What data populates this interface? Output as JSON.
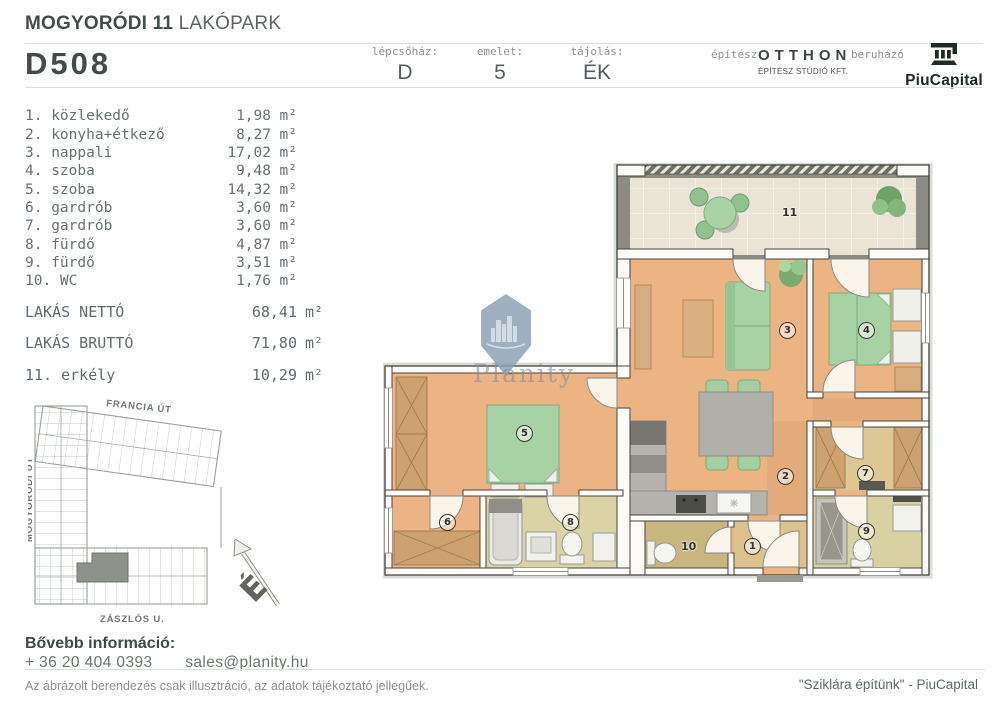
{
  "header": {
    "project_bold": "MOGYORÓDI 11",
    "project_light": "LAKÓPARK",
    "unit_id": "D508",
    "meta": [
      {
        "label": "lépcsőház:",
        "value": "D"
      },
      {
        "label": "emelet:",
        "value": "5"
      },
      {
        "label": "tájolás:",
        "value": "ÉK"
      }
    ],
    "architect_label": "építész",
    "architect_name": "OTTHON",
    "architect_sub": "ÉPÍTÉSZ STÚDIÓ KFT.",
    "developer_label": "beruházó",
    "developer_name": "PiuCapital"
  },
  "units": {
    "m2": "m²"
  },
  "rooms": [
    {
      "name": "1. közlekedő",
      "area": "1,98"
    },
    {
      "name": "2. konyha+étkező",
      "area": "8,27"
    },
    {
      "name": "3. nappali",
      "area": "17,02"
    },
    {
      "name": "4. szoba",
      "area": "9,48"
    },
    {
      "name": "5. szoba",
      "area": "14,32"
    },
    {
      "name": "6. gardrób",
      "area": "3,60"
    },
    {
      "name": "7. gardrób",
      "area": "3,60"
    },
    {
      "name": "8. fürdő",
      "area": "4,87"
    },
    {
      "name": "9. fürdő",
      "area": "3,51"
    },
    {
      "name": "10. WC",
      "area": "1,76"
    }
  ],
  "totals": [
    {
      "label": "LAKÁS NETTÓ",
      "area": "68,41"
    },
    {
      "label": "LAKÁS BRUTTÓ",
      "area": "71,80"
    },
    {
      "label": "11. erkély",
      "area": "10,29"
    }
  ],
  "plan_labels": [
    "1",
    "2",
    "3",
    "4",
    "5",
    "6",
    "7",
    "8",
    "9",
    "10",
    "11"
  ],
  "watermark": "Planity",
  "sitemap": {
    "streets": {
      "top": "FRANCIA ÚT",
      "left": "MOGYORÓDI ÚT",
      "bottom": "ZÁSZLÓS U."
    },
    "compass": "É"
  },
  "contact": {
    "heading": "Bővebb információ:",
    "phone": "+ 36 20 404 0393",
    "email": "sales@planity.hu"
  },
  "footer": {
    "disclaimer": "Az ábrázolt berendezés csak illusztráció, az adatok tájékoztató jellegűek.",
    "slogan": "\"Sziklára építünk\" - PiuCapital"
  }
}
